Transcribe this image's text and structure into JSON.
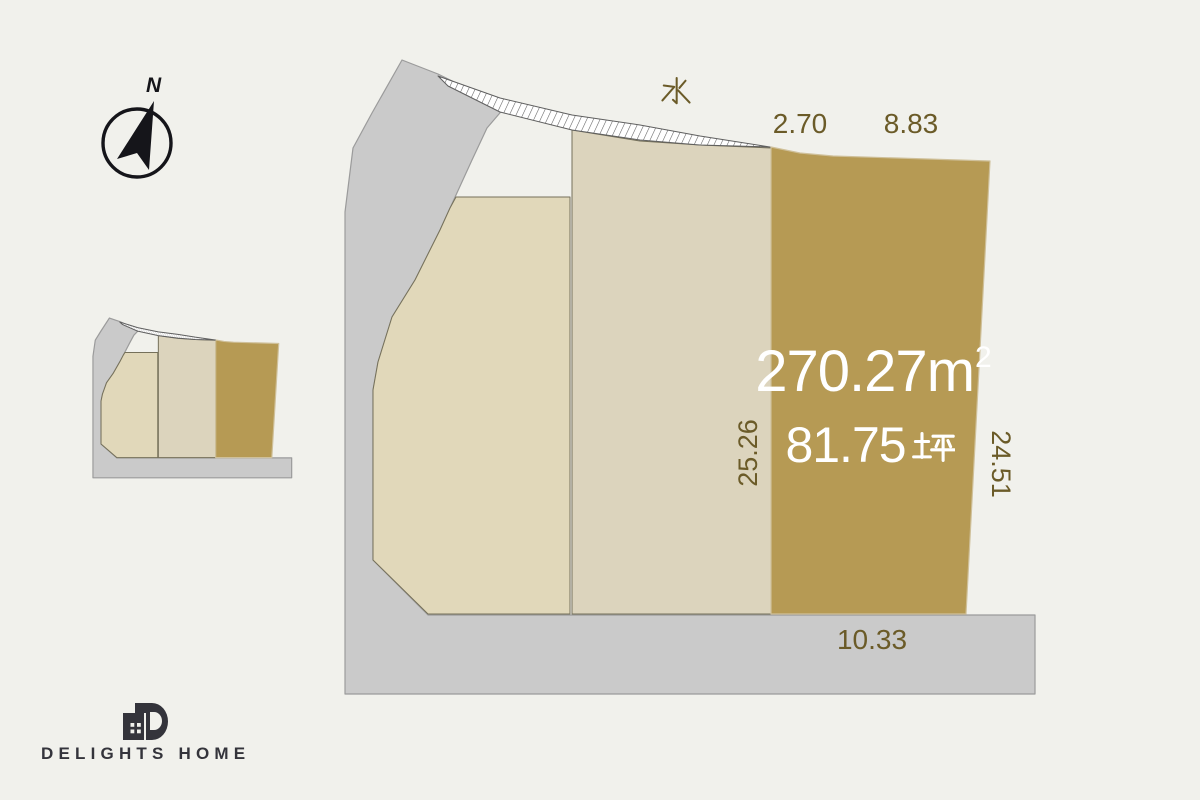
{
  "theme": {
    "background": "#f1f1ec",
    "road_fill": "#cacaca",
    "road_stroke": "#9b9b9b",
    "parcel_left_fill": "#e1d8ba",
    "parcel_middle_fill": "#dcd4bd",
    "parcel_highlight_fill": "#b69a54",
    "parcel_highlight_stroke": "#cfc09a",
    "parcel_stroke": "#75705a",
    "hatch_stroke": "#5f5f5f",
    "dimension_text": "#6b5b28",
    "area_text": "#ffffff",
    "logo_color": "#34343b"
  },
  "compass": {
    "north_label": "N"
  },
  "main_plot": {
    "water_label": "水",
    "top_dimensions": [
      {
        "label": "2.70"
      },
      {
        "label": "8.83"
      }
    ],
    "left_dimension": {
      "label": "25.26"
    },
    "right_dimension": {
      "label": "24.51"
    },
    "bottom_dimension": {
      "label": "10.33"
    },
    "highlight_parcel": {
      "area_sqm_value": "270.27",
      "area_sqm_unit": "m",
      "area_sqm_exponent": "2",
      "area_sqm_full": "270.27m²",
      "area_tsubo_value": "81.75",
      "area_tsubo_unit": "坪",
      "area_tsubo_full": "81.75坪"
    }
  },
  "logo": {
    "text": "DELIGHTS HOME"
  }
}
